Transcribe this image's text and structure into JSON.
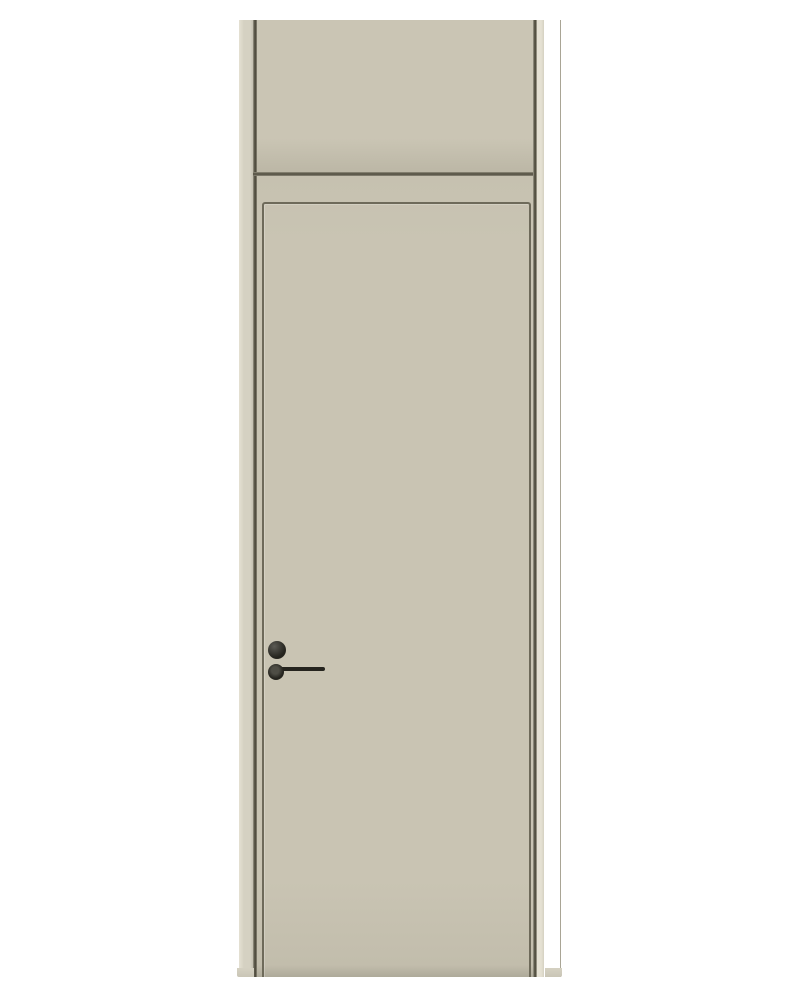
{
  "scene": {
    "type": "product-photo",
    "description": "Light greige interior wooden door with a matching transom panel above, set in a matching frame, fitted with a minimalist black round-rose lever handle and a separate black privacy-lock rose, photographed on a plain white background"
  },
  "colors": {
    "background": "#ffffff",
    "frame": "#d5d1c2",
    "frame_highlight": "#e5e1d3",
    "frame_edge": "#a9a595",
    "transom_top": "#cac5b4",
    "transom_bottom": "#bdb8a7",
    "leaf_top": "#c6c1b0",
    "leaf_mid": "#c9c4b3",
    "leaf_bottom": "#c2bdac",
    "leaf_base_shadow": "#aeaa9a",
    "seam": "#4e4b3d",
    "groove": "#6e6a5a",
    "handle": "#25241e",
    "handle_highlight": "#5c5b55",
    "lock_center": "#4e4d45"
  },
  "door": {
    "parts": {
      "frame_label": "Door frame",
      "transom_label": "Transom panel",
      "leaf_label": "Flush door leaf",
      "groove_label": "Recessed edge groove",
      "handle_label": "Black lever handle",
      "lock_label": "Privacy lock rose"
    }
  }
}
